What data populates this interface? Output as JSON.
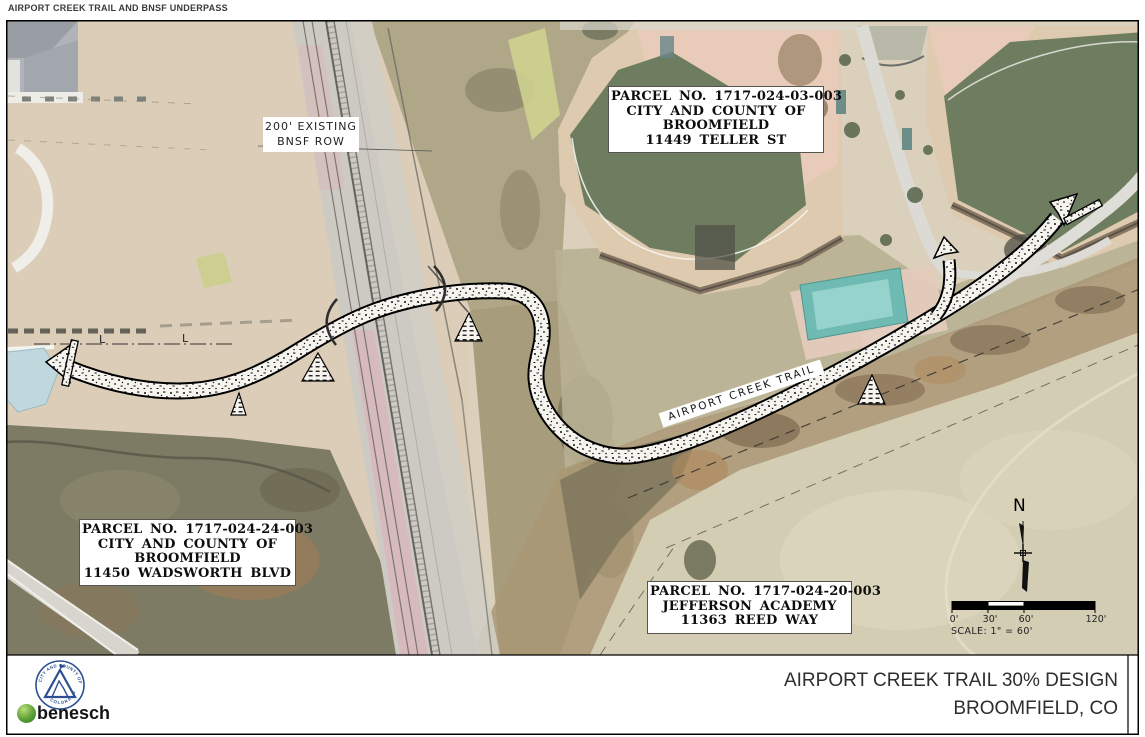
{
  "sheet": {
    "header": "AIRPORT CREEK TRAIL AND BNSF UNDERPASS",
    "title_line1": "AIRPORT CREEK TRAIL 30% DESIGN",
    "title_line2": "BROOMFIELD, CO"
  },
  "map": {
    "row_label": {
      "line1": "200' EXISTING",
      "line2": "BNSF ROW"
    },
    "trail_label": "AIRPORT CREEK TRAIL",
    "parcels": [
      {
        "lines": [
          "PARCEL NO. 1717-024-03-003",
          "CITY AND COUNTY OF",
          "BROOMFIELD",
          "11449 TELLER ST"
        ]
      },
      {
        "lines": [
          "PARCEL NO. 1717-024-24-003",
          "CITY AND COUNTY OF",
          "BROOMFIELD",
          "11450 WADSWORTH BLVD"
        ]
      },
      {
        "lines": [
          "PARCEL NO. 1717-024-20-003",
          "JEFFERSON ACADEMY",
          "11363 REED WAY"
        ]
      }
    ],
    "section_markers": [
      "L",
      "L"
    ],
    "north_label": "N",
    "scale_bar": {
      "ticks": [
        "0'",
        "30'",
        "60'",
        "120'"
      ],
      "caption": "SCALE: 1\" = 60'"
    }
  },
  "footer": {
    "seal": {
      "text_top": "CITY AND COUNTY OF BROOMFIELD",
      "text_bottom": "COLORADO"
    },
    "firm_logo": "benesch"
  },
  "colors": {
    "seal_blue": "#2b4f92",
    "benesch_green": "#5ca035",
    "field_green": "#5e6f4f",
    "infield_clay": "#e6c6b2",
    "rail_ballast_pink": "#d9a7b3",
    "pond_blue": "#b9d3db"
  }
}
